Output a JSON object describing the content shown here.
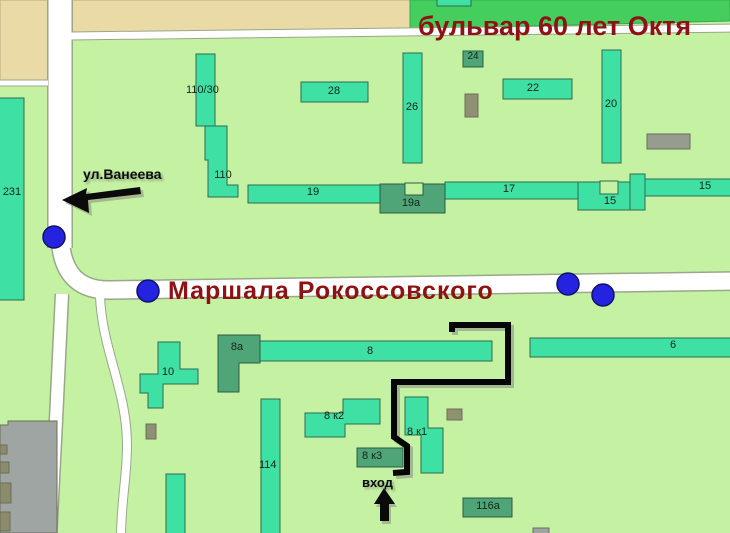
{
  "map": {
    "streets": {
      "boulevard_title": "бульвар 60 лет Октя",
      "main_street": "Маршала Рокоссовского",
      "side_street": "ул.Ванеева"
    },
    "entrance": {
      "label": "вход"
    },
    "buildings": {
      "b231": "231",
      "b110_30": "110/30",
      "b110": "110",
      "b28": "28",
      "b26": "26",
      "b24": "24",
      "b22": "22",
      "b20": "20",
      "b19": "19",
      "b19a": "19а",
      "b17": "17",
      "b15_block": "15",
      "b15_bar": "15",
      "b8a": "8а",
      "b8": "8",
      "b6": "6",
      "b10": "10",
      "b8k2": "8 к2",
      "b8k1": "8 к1",
      "b8k3": "8 к3",
      "b114": "114",
      "b116a": "116а"
    },
    "colors": {
      "background": "#C5F1A2",
      "building_teal": "#3FE0A3",
      "building_dark_green": "#4FA478",
      "boulevard_green": "#44CE5E",
      "beige": "#E9DAA6",
      "road_white": "#FFFFFF",
      "street_label_red": "#8E1212",
      "marker_blue": "#2424E0",
      "gray_building": "#9EA5A2",
      "route_black": "#000000"
    }
  }
}
